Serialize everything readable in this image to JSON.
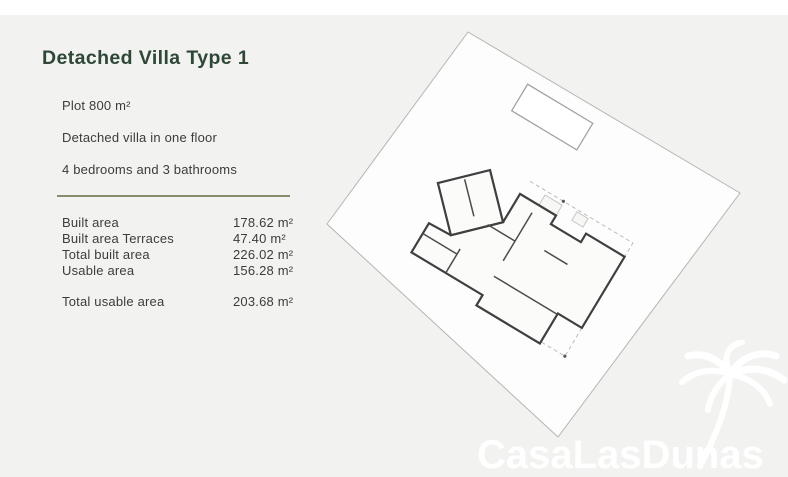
{
  "colors": {
    "background": "#f2f2f0",
    "title_green": "#2e4737",
    "divider_olive": "#8b8b70",
    "body_text": "#3c3c3c",
    "plan_wall": "#3f3f3f",
    "watermark_white": "#ffffff"
  },
  "header": {
    "title": "Detached Villa Type 1"
  },
  "specs": {
    "plot": "Plot 800 m²",
    "floors": "Detached villa in one floor",
    "rooms": "4 bedrooms and 3 bathrooms"
  },
  "areas": {
    "rows": [
      {
        "label": "Built area",
        "value": "178.62 m²"
      },
      {
        "label": "Built area Terraces",
        "value": "47.40 m²"
      },
      {
        "label": "Total built area",
        "value": "226.02 m²"
      },
      {
        "label": "Usable area",
        "value": "156.28 m²"
      }
    ],
    "total": {
      "label": "Total usable area",
      "value": "203.68 m²"
    }
  },
  "floorplan": {
    "features": [
      "plot-boundary",
      "swimming-pool",
      "villa-floor-plan",
      "terrace-dashed-outline"
    ]
  },
  "watermark": {
    "text": "CasaLasDunas",
    "icon": "palm-tree-icon"
  }
}
